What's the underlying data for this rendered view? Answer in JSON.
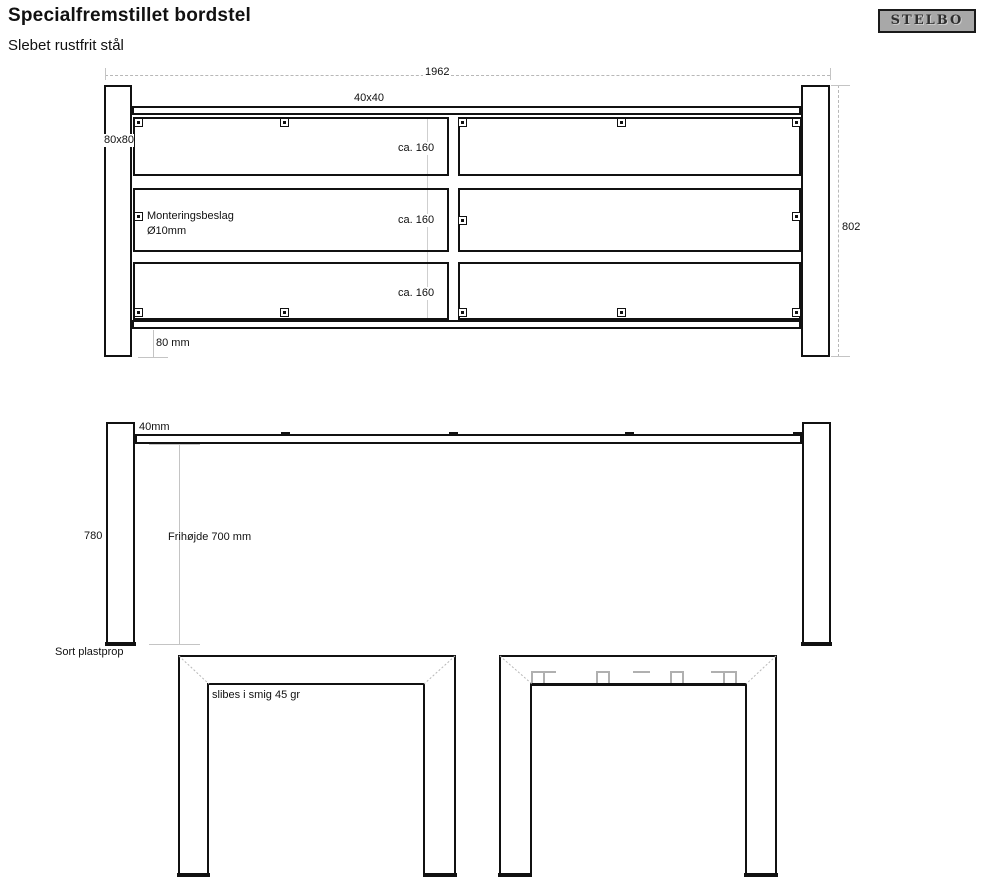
{
  "page": {
    "title": "Specialfremstillet bordstel",
    "subtitle": "Slebet rustfrit stål"
  },
  "logo": {
    "text": "STELBO"
  },
  "colors": {
    "background": "#ffffff",
    "line": "#111111",
    "dim_line": "#b8b8b8",
    "text": "#111111",
    "logo_bg": "#a8a8a8",
    "logo_border": "#1a1a1a"
  },
  "icons": {
    "mounting_bracket": "square-with-center-dot",
    "bracket_side_view": "short-thick-dash",
    "bracket_section": "gray-open-square"
  },
  "top_view": {
    "dim_width": "1962",
    "dim_height": "802",
    "rail_label": "40x40",
    "leg_label": "80x80",
    "spacing_labels": [
      "ca. 160",
      "ca. 160",
      "ca. 160"
    ],
    "bracket_note_line1": "Monteringsbeslag",
    "bracket_note_line2": "Ø10mm",
    "edge_offset_label": "80 mm"
  },
  "front_view": {
    "rail_label": "40mm",
    "leg_height": "780",
    "clearance_label": "Frihøjde 700 mm",
    "foot_label": "Sort plastprop"
  },
  "end_views": {
    "miter_label": "slibes i smig 45 gr"
  }
}
